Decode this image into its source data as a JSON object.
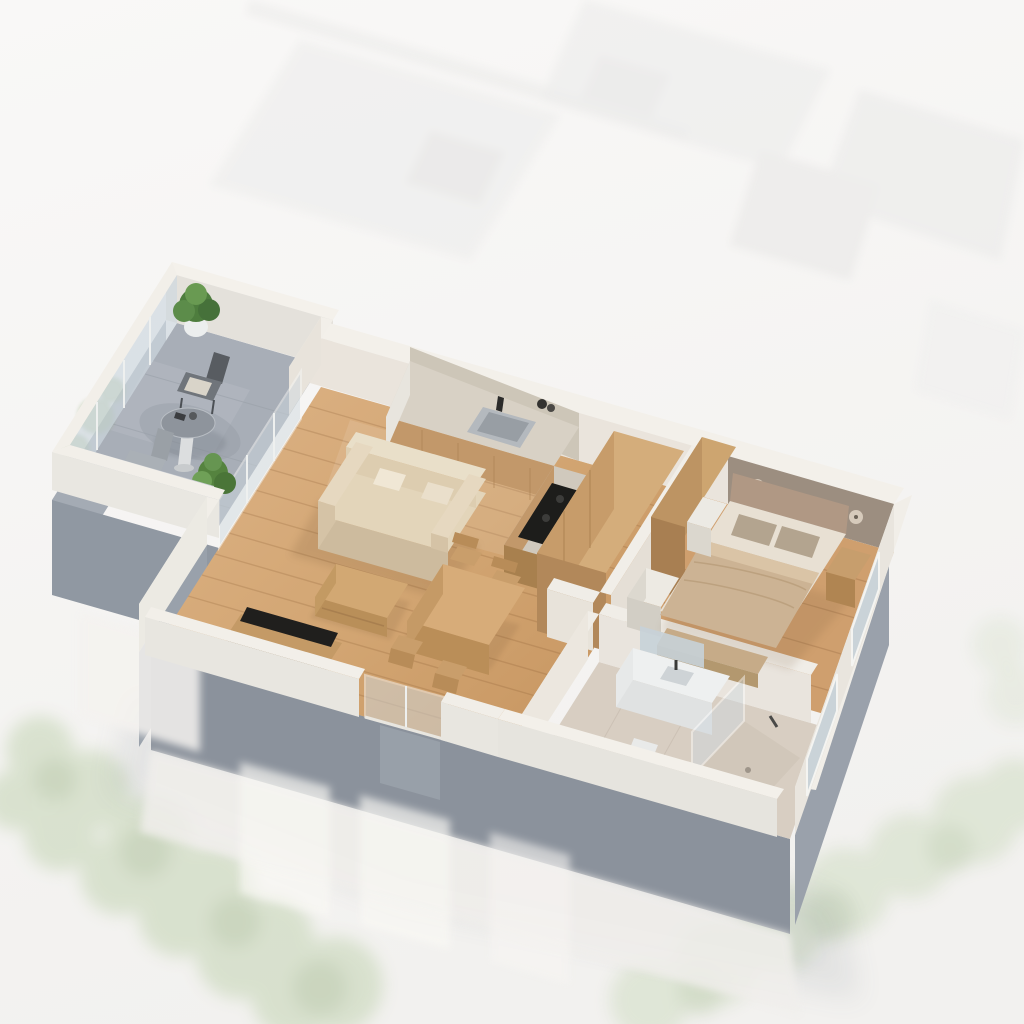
{
  "scene": {
    "type": "3d-floorplan-cutaway-render",
    "view": "isometric-top",
    "rooms": [
      {
        "name": "terrace",
        "furniture": [
          "potted-plant",
          "metal-armchair",
          "round-bistro-table",
          "metal-side-chair",
          "potted-plant"
        ]
      },
      {
        "name": "living-room",
        "furniture": [
          "two-seat-sofa",
          "coffee-table",
          "tv-lowboard"
        ]
      },
      {
        "name": "kitchen",
        "furniture": [
          "counter-with-sink",
          "induction-cooktop",
          "tall-cabinet"
        ]
      },
      {
        "name": "dining-area",
        "furniture": [
          "dining-table",
          "chair",
          "chair",
          "chair",
          "chair"
        ]
      },
      {
        "name": "bedroom",
        "furniture": [
          "double-bed",
          "wardrobe",
          "dresser",
          "nightstand-west",
          "nightstand-east",
          "foot-bench"
        ]
      },
      {
        "name": "bathroom",
        "furniture": [
          "vanity-with-sink",
          "mirror",
          "toilet",
          "walk-in-shower"
        ]
      }
    ]
  },
  "palette": {
    "bg_top": "#f8f7f6",
    "bg_bottom": "#f2f1ef",
    "ghost_block": "#e9e8e7",
    "ghost_green": "#bccfa9",
    "ghost_green_dark": "#9db885",
    "wood_floor_a": "#ddb386",
    "wood_floor_b": "#c6945f",
    "wood_floor_bedroom": "#cf9f6e",
    "terrace_floor": "#a8aeb7",
    "tile_floor": "#d8cec2",
    "wall_top": "#f3f0ea",
    "wall_light": "#eae4dc",
    "wall_shadow": "#c6cad1",
    "slab_gray": "#8b929c",
    "slab_gray_light": "#9aa1ab",
    "glass": "#cfd9df",
    "backsplash_stone": "#cdc6b8",
    "headboard_taupe": "#9c8e80",
    "sofa_beige": "#e3d5ba",
    "sofa_shade": "#cdbb9e",
    "duvet_tan": "#ccb394",
    "pillow_taupe": "#b3a48f",
    "mattress_white": "#e8e0d3",
    "furniture_wood": "#d4ad7b",
    "furniture_wood_dark": "#b2885a",
    "worktop": "#d8d1c5",
    "cooktop_black": "#1d1d1b",
    "tv_black": "#201f1d",
    "plant_green": "#4e7d3e",
    "plant_green_light": "#6fa057",
    "metal_gray": "#70757b",
    "fixture_white": "#eef0f0",
    "mirror_glass": "#c7d2d8"
  }
}
